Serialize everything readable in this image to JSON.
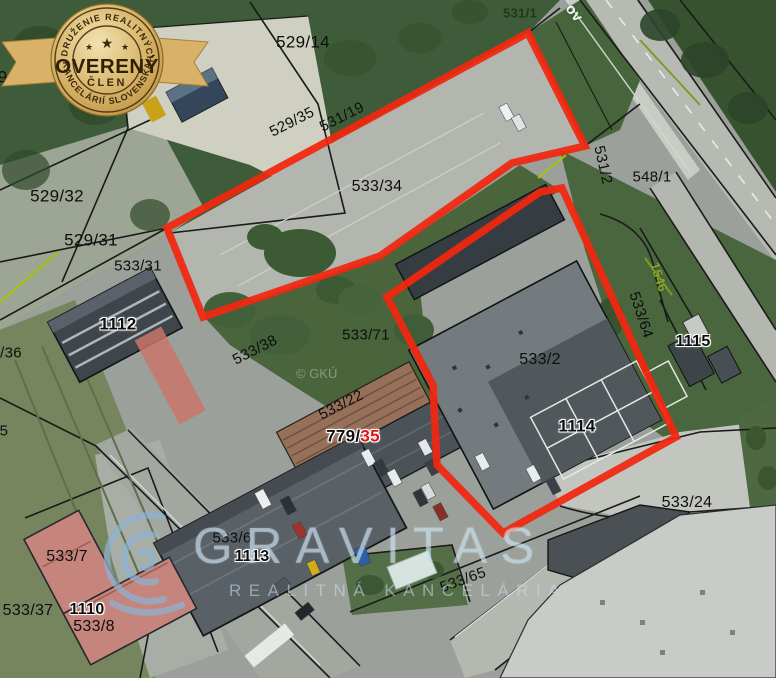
{
  "map": {
    "street_label": "ov",
    "attribution": "© GKÚ",
    "labels": [
      {
        "text": "531/1"
      },
      {
        "text": "529/14"
      },
      {
        "text": "29/33"
      },
      {
        "text": "529/35"
      },
      {
        "text": "531/19"
      },
      {
        "text": "533/34"
      },
      {
        "text": "531/2"
      },
      {
        "text": "548/1"
      },
      {
        "text": "529/32"
      },
      {
        "text": "529/31"
      },
      {
        "text": "533/31"
      },
      {
        "text": "1112"
      },
      {
        "text": "/36"
      },
      {
        "text": "533/38"
      },
      {
        "text": "533/71"
      },
      {
        "text": "1546"
      },
      {
        "text": "533/64"
      },
      {
        "text": "1115"
      },
      {
        "text": "533/2"
      },
      {
        "text": "533/22"
      },
      {
        "text": "1114"
      },
      {
        "text": "5"
      },
      {
        "text": "533/7"
      },
      {
        "text": "533/37"
      },
      {
        "text": "1110"
      },
      {
        "text": "533/8"
      },
      {
        "text": "533/6"
      },
      {
        "text": "1113"
      },
      {
        "text": "533/65"
      },
      {
        "text": "533/24"
      }
    ],
    "combo_label": {
      "prefix": "779/",
      "highlight": "35"
    },
    "colors": {
      "selection_red": "#f2270f",
      "badge_gold": "#d4ab5e",
      "watermark_blue": "#c6ddee",
      "highlight_red_text": "#e11414",
      "green_parcel_text": "#8ca32e"
    }
  },
  "watermark": {
    "brand": "GRAVITAS",
    "tagline": "REALITNÁ KANCELÁRIA"
  },
  "badge": {
    "arc_top": "ZDRUŽENIE REALITNÝCH",
    "title": "OVERENÝ",
    "subtitle": "ČLEN",
    "arc_bottom": "KANCELÁRIÍ SLOVENSKA",
    "star": "★"
  }
}
